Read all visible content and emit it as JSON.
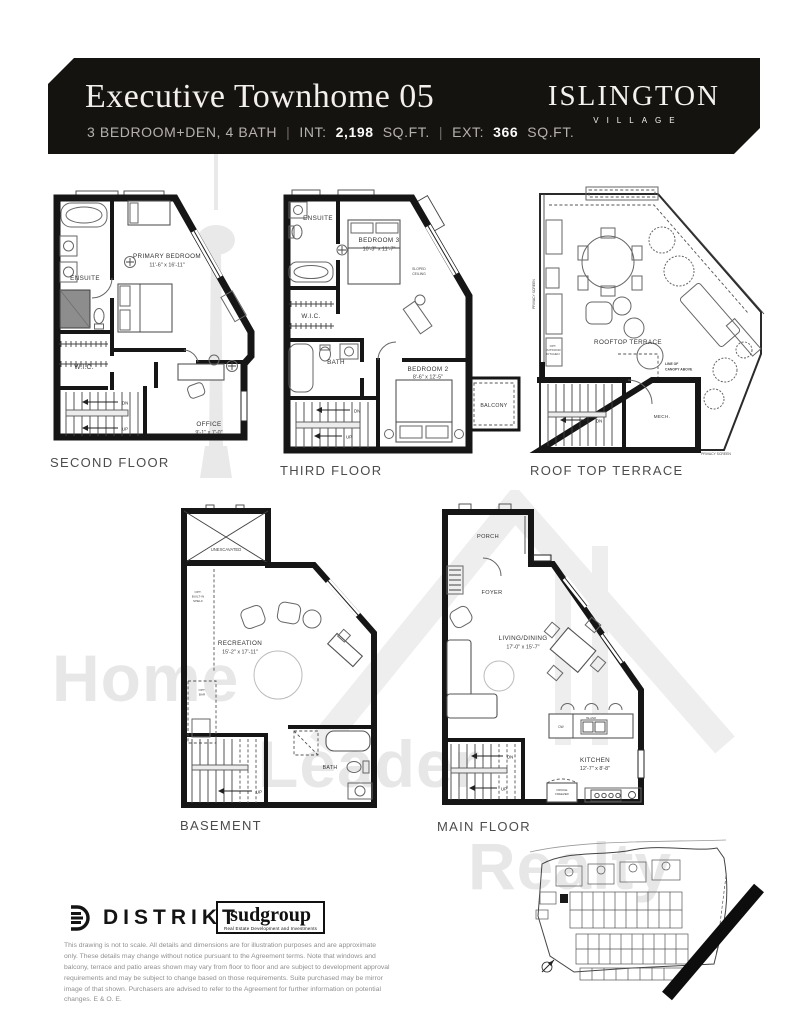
{
  "header": {
    "title": "Executive Townhome 05",
    "specs": "3 BEDROOM+DEN, 4 BATH",
    "sep": "|",
    "int_label": "INT:",
    "int_value": "2,198",
    "int_unit": "SQ.FT.",
    "ext_label": "EXT:",
    "ext_value": "366",
    "ext_unit": "SQ.FT.",
    "brand_name": "ISLINGTON",
    "brand_sub": "VILLAGE"
  },
  "plans": {
    "second_floor": {
      "label": "SECOND FLOOR",
      "rooms": {
        "ensuite": "ENSUITE",
        "primary_bedroom": "PRIMARY BEDROOM",
        "primary_bedroom_dims": "11'-6\" x 16'-11\"",
        "wic": "W.I.C.",
        "office": "OFFICE",
        "office_dims": "9'-1\" x 7'-0\"",
        "dn": "DN",
        "up": "UP"
      }
    },
    "third_floor": {
      "label": "THIRD FLOOR",
      "rooms": {
        "ensuite": "ENSUITE",
        "bedroom3": "BEDROOM 3",
        "bedroom3_dims": "10'-3\" x 11'-7\"",
        "wic": "W.I.C.",
        "bath": "BATH",
        "bedroom2": "BEDROOM 2",
        "bedroom2_dims": "8'-6\" x 12'-5\"",
        "balcony": "BALCONY",
        "sloped_1": "SLOPED",
        "sloped_2": "CEILING",
        "dn": "DN",
        "up": "UP"
      }
    },
    "roof_top_terrace": {
      "label": "ROOF TOP TERRACE",
      "rooms": {
        "rooftop_terrace": "ROOFTOP TERRACE",
        "mech": "MECH.",
        "canopy_1": "LINE OF",
        "canopy_2": "CANOPY ABOVE",
        "privacy_screen_left": "PRIVACY SCREEN",
        "privacy_screen_bottom": "PRIVACY SCREEN",
        "opt_kitchen_1": "OPT.",
        "opt_kitchen_2": "OUTDOOR",
        "opt_kitchen_3": "KITCHEN",
        "dn": "DN"
      }
    },
    "basement": {
      "label": "BASEMENT",
      "rooms": {
        "unexcavated": "UNEXCAVATED",
        "recreation": "RECREATION",
        "recreation_dims": "15'-2\" x 17'-11\"",
        "bath": "BATH",
        "opt_shelf_1": "OPT.",
        "opt_shelf_2": "BUILT-IN",
        "opt_shelf_3": "SHELF",
        "opt_bar_1": "OPT.",
        "opt_bar_2": "BAR",
        "up": "UP"
      }
    },
    "main_floor": {
      "label": "MAIN FLOOR",
      "rooms": {
        "porch": "PORCH",
        "foyer": "FOYER",
        "living_dining": "LIVING/DINING",
        "living_dining_dims": "17'-0\" x 15'-7\"",
        "kitchen": "KITCHEN",
        "kitchen_dims": "12'-7\" x 8'-8\"",
        "island": "ISLAND",
        "dw": "DW",
        "fridge_1": "FRIDGE",
        "fridge_2": "FREEZER",
        "dn": "DN",
        "up": "UP"
      }
    }
  },
  "footer": {
    "distrikt": "DISTRIKT",
    "sudgroup": "sudgroup",
    "sudgroup_tagline": "Real Estate Development and Investments",
    "disclaimer": "This drawing is not to scale. All details and dimensions are for illustration purposes and are approximate only. These details may change without notice pursuant to the Agreement terms. Note that windows and balcony, terrace and patio areas shown may vary from floor to floor and are subject to development approval requirements and may be subject to change based on those requirements. Suite purchased may be mirror image of that shown. Purchasers are advised to refer to the Agreement for further information on potential changes. E & O. E."
  },
  "watermark": {
    "word1": "Home",
    "word2": "Leader",
    "word3": "Realty"
  },
  "colors": {
    "header_bg": "#151310",
    "ink": "#161616",
    "floor_label": "#4c4c4c",
    "watermark": "#e7e7e7"
  }
}
